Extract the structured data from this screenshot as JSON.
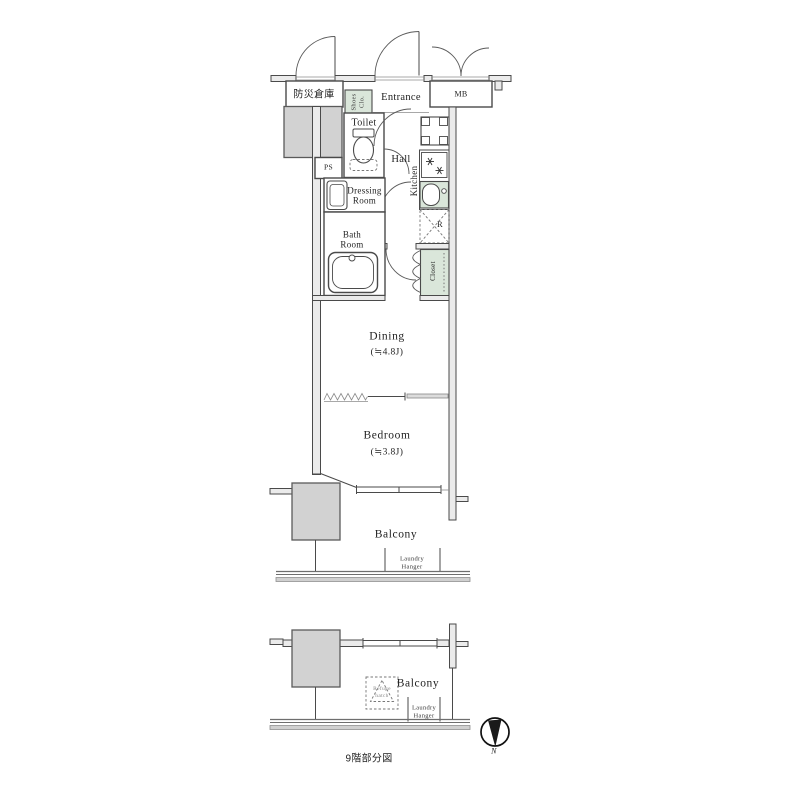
{
  "caption": "9階部分図",
  "colors": {
    "wall_line": "#4a4a4a",
    "wall_fill": "#ebebeb",
    "column_fill": "#d2d2d2",
    "fixture_green": "#dae6da",
    "rail_gray": "#d0d0d0"
  },
  "plan": {
    "storage_label": "防災倉庫",
    "shoes_closet_label": "Shoes\nClo.",
    "entrance_label": "Entrance",
    "meter_box_label": "MB",
    "toilet_label": "Toilet",
    "pipe_space_label": "PS",
    "hall_label": "Hall",
    "kitchen_label": "Kitchen",
    "dressing_room_label": "Dressing\nRoom",
    "bath_room_label": "Bath\nRoom",
    "closet_label": "Closet",
    "refrigerator_label": "R",
    "dining_label": "Dining",
    "dining_size": "(≒4.8J)",
    "bedroom_label": "Bedroom",
    "bedroom_size": "(≒3.8J)",
    "balcony_label": "Balcony",
    "laundry_hanger_label": "Laundry\nHanger"
  },
  "lower_plan": {
    "balcony_label": "Balcony",
    "refuge_hatch_label": "Refuge\nhatch",
    "laundry_hanger_label": "Laundry\nHanger"
  },
  "compass": {
    "north_label": "N"
  }
}
